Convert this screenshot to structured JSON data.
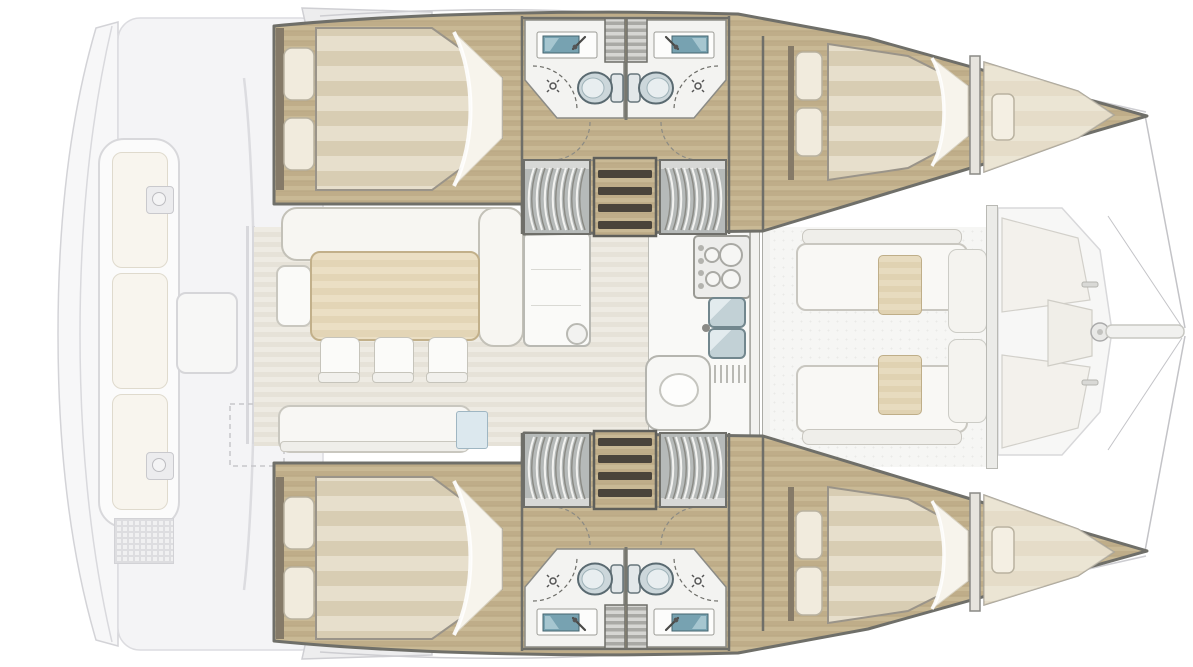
{
  "diagram": {
    "type": "yacht-floor-plan",
    "subject": "sailing catamaran accommodation and deck layout, overhead view",
    "orientation": {
      "bow": "right",
      "stern": "left"
    },
    "aft_cockpit": {
      "furniture": [
        "bench-sofa-3-cushions",
        "cockpit-table",
        "grill-unit",
        "grill-unit",
        "deck-hatch",
        "liferaft-locker-dashed",
        "transom-platform"
      ]
    },
    "salon": {
      "furniture": [
        "l-shaped-sofa",
        "side-seat",
        "dining-table",
        "dining-chair",
        "dining-chair",
        "dining-chair",
        "sideboard-console",
        "stool",
        "aft-sofa",
        "chart-table"
      ]
    },
    "galley": {
      "fixtures": [
        "stove-4-burners",
        "double-sink",
        "dish-drain",
        "lower-cabinet-with-bowl"
      ]
    },
    "forward_cockpit": {
      "furniture": [
        "lounge-sofa",
        "lounge-sofa",
        "cocktail-table",
        "cocktail-table",
        "sunpad",
        "sunpad"
      ]
    },
    "foredeck": {
      "fixtures": [
        "deck-panel",
        "deck-panel",
        "anchor-locker",
        "windlass",
        "bow-cleat",
        "bow-cleat",
        "bowsprit",
        "rigging-lines"
      ]
    },
    "starboard_hull": {
      "aft_cabin": {
        "furniture": [
          "double-bed",
          "pillow",
          "pillow"
        ]
      },
      "bathrooms": [
        {
          "fixtures": [
            "sink",
            "faucet",
            "toilet",
            "shower",
            "shower-door-arc"
          ]
        },
        {
          "fixtures": [
            "sink",
            "faucet",
            "toilet",
            "shower",
            "shower-door-arc"
          ]
        }
      ],
      "circulation": [
        "companionway-steps",
        "hanging-locker",
        "hanging-locker",
        "door-swing-arcs"
      ],
      "forward_cabin": {
        "furniture": [
          "double-bed",
          "pillow",
          "pillow"
        ]
      },
      "forepeak": {
        "furniture": [
          "berth",
          "pillow"
        ]
      }
    },
    "port_hull": {
      "aft_cabin": {
        "furniture": [
          "double-bed",
          "pillow",
          "pillow"
        ]
      },
      "bathrooms": [
        {
          "fixtures": [
            "sink",
            "faucet",
            "toilet",
            "shower",
            "shower-door-arc"
          ]
        },
        {
          "fixtures": [
            "sink",
            "faucet",
            "toilet",
            "shower",
            "shower-door-arc"
          ]
        }
      ],
      "circulation": [
        "companionway-steps",
        "hanging-locker",
        "hanging-locker",
        "door-swing-arcs"
      ],
      "forward_cabin": {
        "furniture": [
          "double-bed",
          "pillow",
          "pillow"
        ]
      },
      "forepeak": {
        "furniture": [
          "berth",
          "pillow"
        ]
      }
    },
    "counts": {
      "double_cabins": 4,
      "bathrooms": 4,
      "forepeak_berths": 2,
      "dining_chairs": 3
    }
  },
  "palette": {
    "hull_floor_wood": "#c4b38f",
    "bed_stripe_light": "#e7dfcc",
    "bed_stripe_dark": "#d8cdb3",
    "bathroom_floor": "#f3f3f1",
    "sink_basin": "#77a2b1",
    "toilet_body": "#ccd7db",
    "wall_outline": "#6f6f69",
    "salon_floor": "#ece9e1",
    "table_wood": "#e8dcc0",
    "faded_deck": "#f5f5f6",
    "faded_outline": "#d6d6da"
  }
}
